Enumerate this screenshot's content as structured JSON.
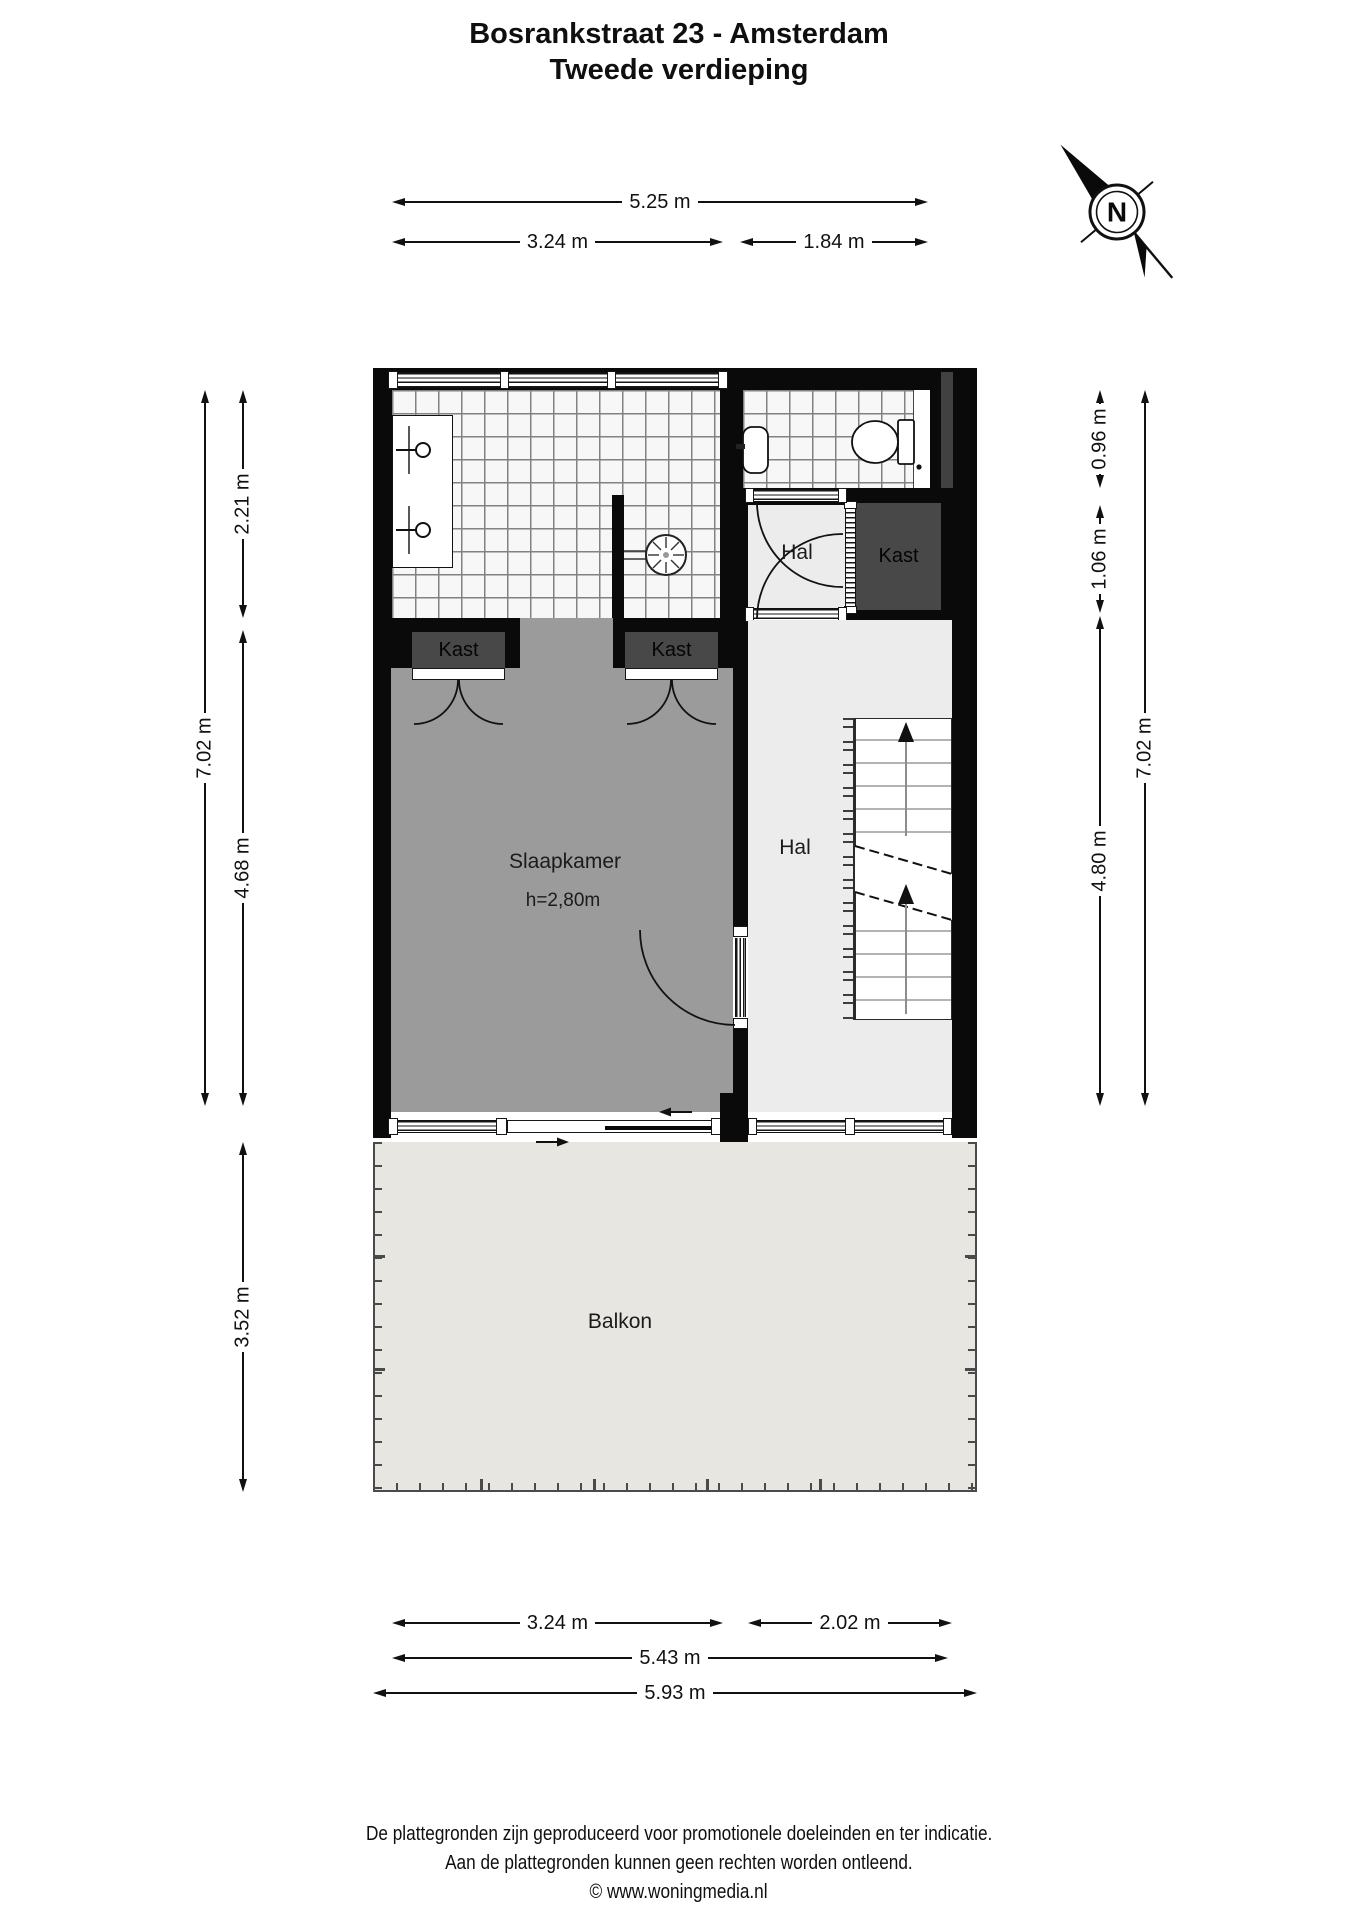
{
  "header": {
    "line1": "Bosrankstraat 23 - Amsterdam",
    "line2": "Tweede verdieping"
  },
  "compass": {
    "label": "N"
  },
  "rooms": {
    "bedroom": {
      "label": "Slaapkamer",
      "ceiling_height": "h=2,80m"
    },
    "hall_upper": "Hal",
    "hall_main": "Hal",
    "closet_hall": "Kast",
    "closet_bedroom_left": "Kast",
    "closet_bedroom_right": "Kast",
    "balcony": "Balkon"
  },
  "dimensions": {
    "top": {
      "total": "5.25 m",
      "segments": [
        "3.24 m",
        "1.84 m"
      ]
    },
    "left": {
      "total": "7.02 m",
      "segments": [
        "2.21 m",
        "4.68 m"
      ],
      "balcony": "3.52 m"
    },
    "right": {
      "total": "7.02 m",
      "segments": [
        "0.96 m",
        "1.06 m",
        "4.80 m"
      ]
    },
    "bottom": {
      "row1": [
        "3.24 m",
        "2.02 m"
      ],
      "row2": "5.43 m",
      "row3": "5.93 m"
    }
  },
  "footer": {
    "line1": "De plattegronden zijn geproduceerd voor promotionele doeleinden en ter indicatie.",
    "line2": "Aan de plattegronden kunnen geen rechten worden ontleend.",
    "line3": "© www.woningmedia.nl"
  },
  "colors": {
    "wall": "#0a0a0a",
    "bedroom_floor": "#9b9b9b",
    "hall_floor": "#ececec",
    "closet_fill": "#484848",
    "balcony_floor": "#e8e6e1",
    "tile_grout": "#828282"
  }
}
